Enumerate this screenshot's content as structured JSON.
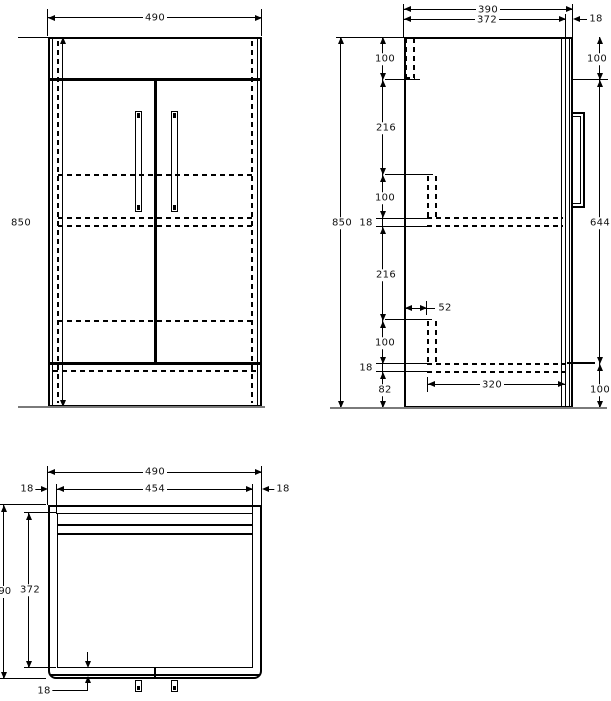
{
  "front_view": {
    "width": "490",
    "height": "850"
  },
  "side_view": {
    "depth_overall": "390",
    "depth_carcass": "372",
    "door_thickness": "18",
    "height": "850",
    "segments": {
      "top_rail": "100",
      "upper": "216",
      "mid": "100",
      "shelf": "18",
      "lower": "216",
      "front_rail_depth": "52",
      "bottom": "100",
      "base_panel": "18",
      "plinth": "82"
    },
    "door": {
      "top_offset": "100",
      "height": "644",
      "bottom_offset": "100"
    },
    "base_width": "320"
  },
  "plan_view": {
    "width_overall": "490",
    "width_carcass": "454",
    "side_panel_left": "18",
    "side_panel_right": "18",
    "depth_overall": "390",
    "depth_carcass": "372",
    "door_thickness": "18"
  }
}
